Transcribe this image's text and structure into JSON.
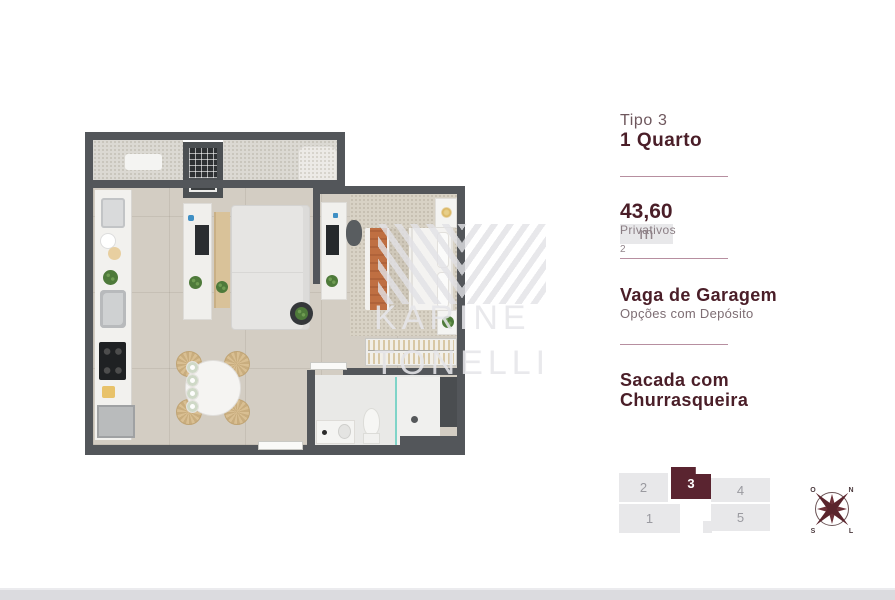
{
  "panel": {
    "type_label": "Tipo 3",
    "type_name": "1 Quarto",
    "area": {
      "value": "43,60",
      "unit": "m",
      "superscript": "2",
      "caption": "Privativos"
    },
    "garage": {
      "title": "Vaga de Garagem",
      "caption": "Opções com Depósito"
    },
    "balcony": {
      "line1": "Sacada com",
      "line2": "Churrasqueira"
    }
  },
  "unit_map": {
    "highlighted": "3",
    "units": [
      {
        "label": "1"
      },
      {
        "label": "2"
      },
      {
        "label": "3"
      },
      {
        "label": "4"
      },
      {
        "label": "5"
      }
    ]
  },
  "compass": {
    "west": "O",
    "north": "N",
    "south": "S",
    "east": "L"
  },
  "watermark": {
    "line1": "KARINE",
    "line2": "TONELLI"
  },
  "colors": {
    "brand_dark": "#4a1e28",
    "brand_mid": "#6e575d",
    "caption": "#8b7e84",
    "divider": "#b78fa0",
    "unit_highlight": "#5a2430",
    "unit_bg": "#e8e8ea",
    "unit_number": "#9a9aa0",
    "wall": "#53565a",
    "floor": "#d3cdc3",
    "wood": "#d9c299",
    "bed_runner": "#bf6f42",
    "shower_glass": "#7fd4c8",
    "bottom_bar": "#dbdbdf"
  }
}
